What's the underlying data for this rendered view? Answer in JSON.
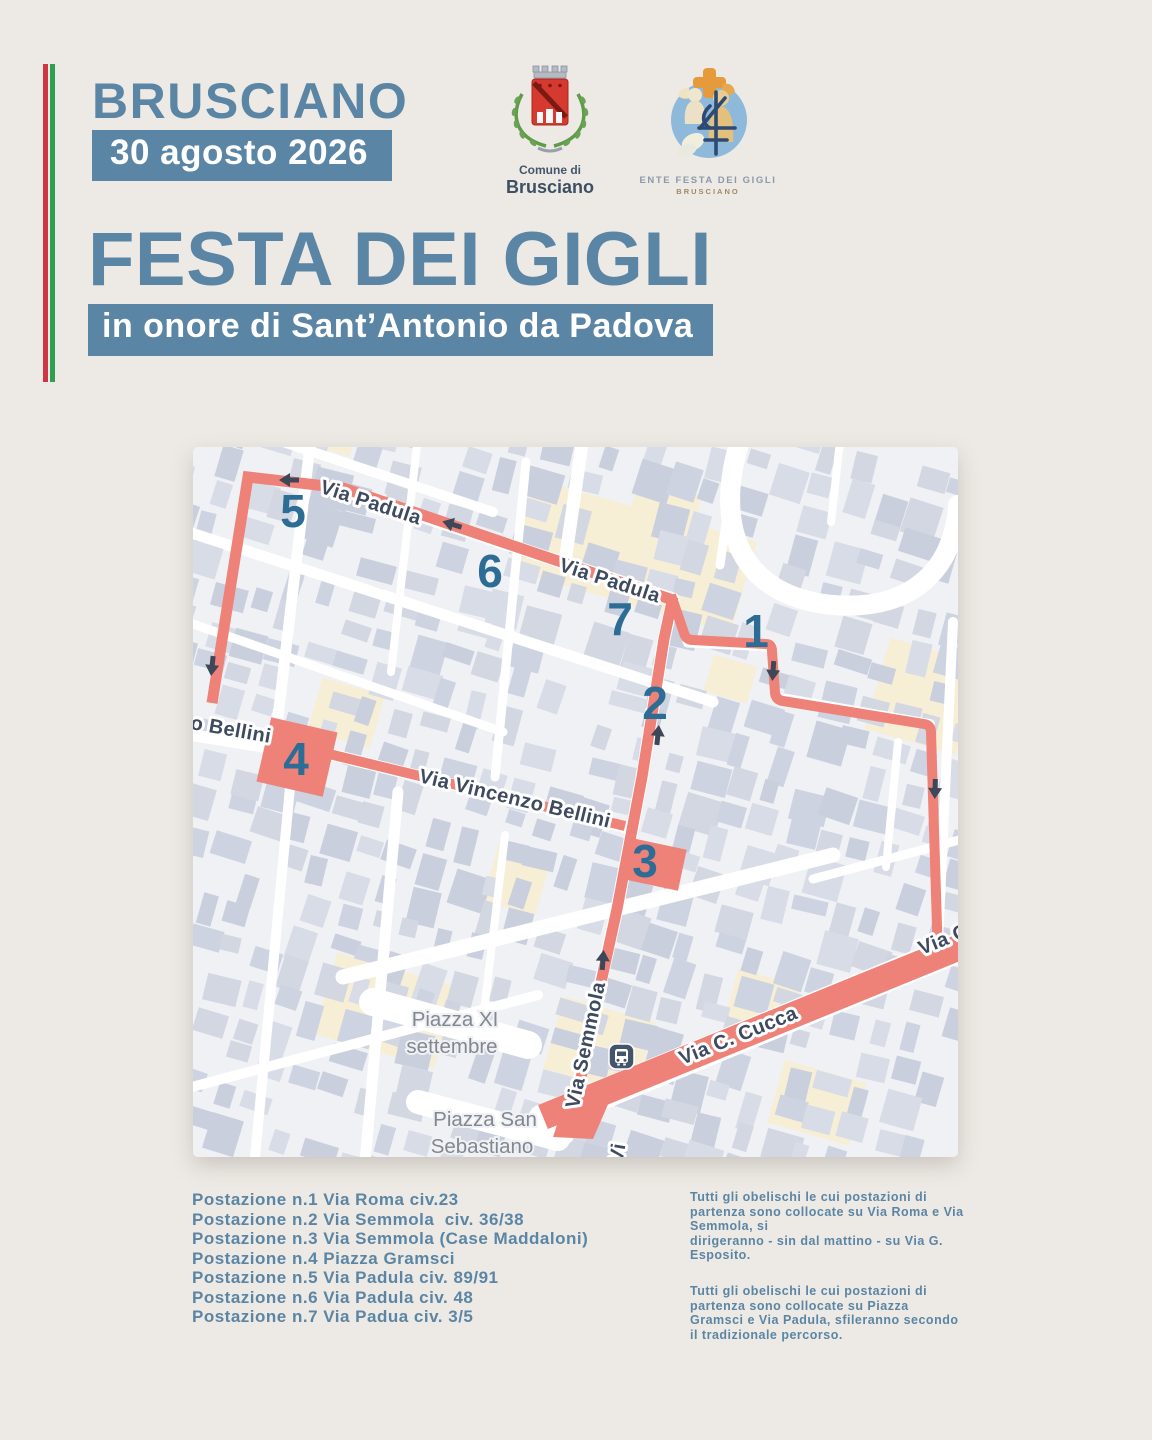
{
  "page": {
    "bg": "#edeae5",
    "accent": "#5b85a4"
  },
  "header": {
    "city": "BRUSCIANO",
    "date": "30 agosto 2026"
  },
  "logos": {
    "comune": {
      "caption_top": "Comune di",
      "caption_bottom": "Brusciano"
    },
    "ente": {
      "caption_top": "ENTE FESTA DEI GIGLI",
      "caption_bottom": "BRUSCIANO"
    }
  },
  "title": "FESTA DEI GIGLI",
  "subtitle": "in onore di Sant’Antonio da Padova",
  "map": {
    "colors": {
      "route": "#ee8278",
      "station_number": "#2d6d95"
    },
    "stations": [
      "1",
      "2",
      "3",
      "4",
      "5",
      "6",
      "7"
    ],
    "street_labels": {
      "padula_1": "Via Padula",
      "padula_2": "Via Padula",
      "bellini_end": "o Bellini",
      "vincenzo_bellini": "Via Vincenzo Bellini",
      "semmola": "Via Semmola",
      "cucca": "Via C. Cucca",
      "cucca_edge": "Via C",
      "via_fragment": "Vi"
    },
    "places": {
      "piazza_xi_1": "Piazza XI",
      "piazza_xi_2": "settembre",
      "piazza_ss_1": "Piazza San",
      "piazza_ss_2": "Sebastiano"
    }
  },
  "legend": [
    "Postazione n.1 Via Roma civ.23",
    "Postazione n.2 Via Semmola  civ. 36/38",
    "Postazione n.3 Via Semmola (Case Maddaloni)",
    "Postazione n.4 Piazza Gramsci",
    "Postazione n.5 Via Padula civ. 89/91",
    "Postazione n.6 Via Padula civ. 48",
    "Postazione n.7 Via Padua civ. 3/5"
  ],
  "notes": [
    "Tutti gli obelischi le cui postazioni di\npartenza sono collocate su Via Roma e Via\nSemmola, si\ndirigeranno - sin dal mattino - su Via G.\nEsposito.",
    "Tutti gli obelischi le cui postazioni di\npartenza sono collocate su Piazza\nGramsci e  Via Padula, sfileranno secondo\nil tradizionale percorso."
  ]
}
